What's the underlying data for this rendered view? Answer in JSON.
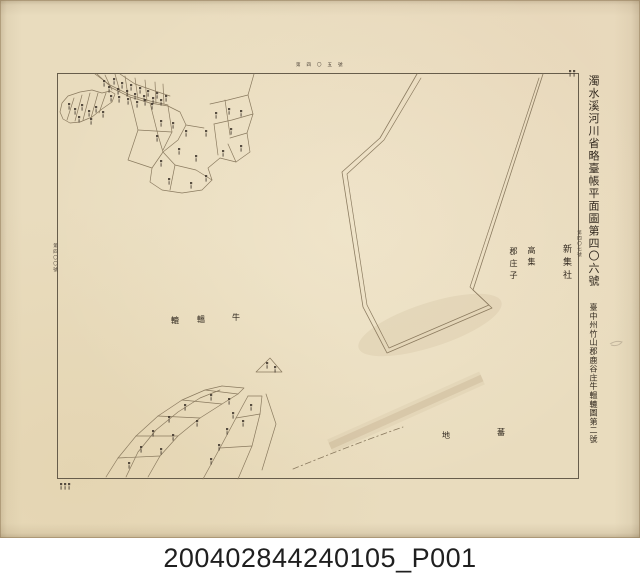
{
  "archive": {
    "caption": "200402844240105_P001"
  },
  "map": {
    "title_main": "濁水溪河川省略臺帳平面圖第四〇六號",
    "title_sub": "臺中州竹山郡鹿谷庄牛轀轆圖第二號",
    "adjacent_sheet_right": "第四〇七號",
    "adjacent_sheet_top": "第四〇五號",
    "adjacent_sheet_left": "第四〇〇號",
    "place_labels": {
      "shin_shu_sha": "新集社",
      "ko_shu": "高集",
      "gun_sho_shi": "郡庄子",
      "gyu_on_roku_char1": "牛",
      "gyu_on_roku_char2": "轀",
      "gyu_on_roku_char3": "轆",
      "ban_chi_char1": "蕃",
      "ban_chi_char2": "地"
    },
    "colors": {
      "paper": "#e9dcbe",
      "map_line": "#8a7a5f",
      "frame_line": "#675d4b",
      "ink": "#342b21",
      "caption_text": "#1f1f1f",
      "caption_background": "#ffffff"
    }
  }
}
